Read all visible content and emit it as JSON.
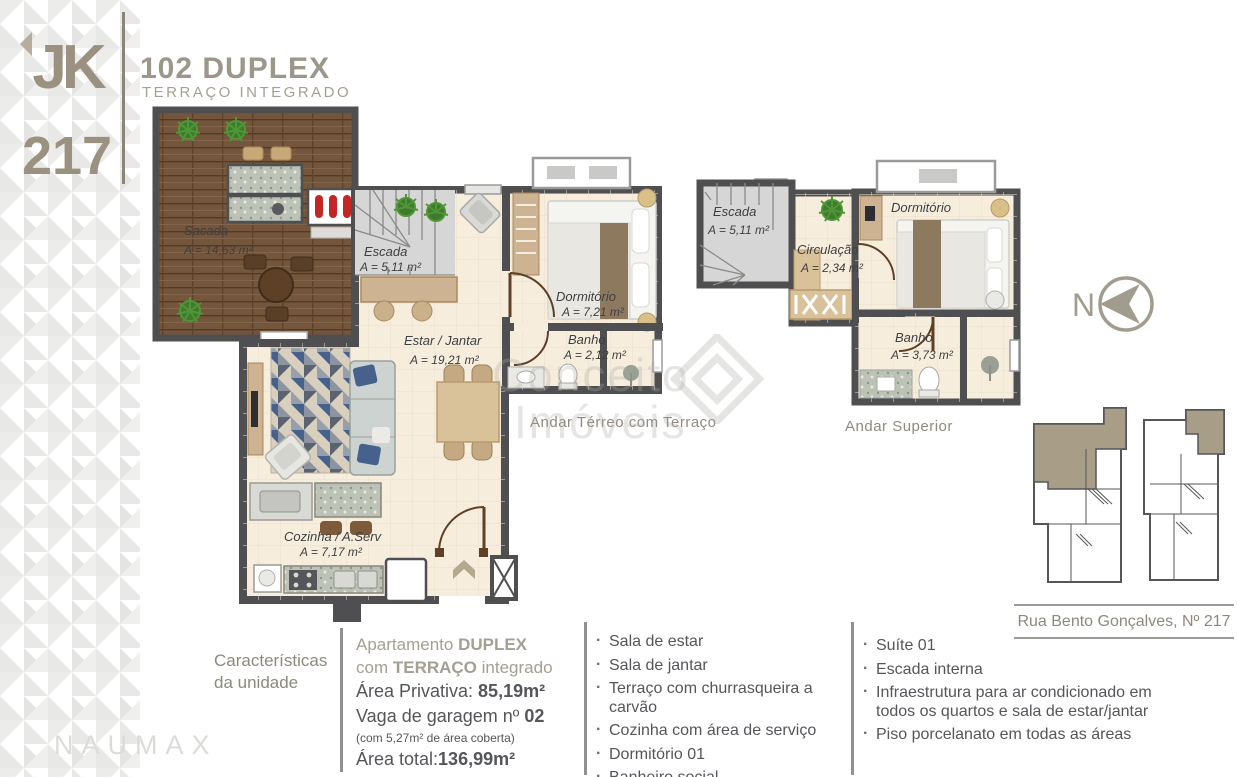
{
  "logo": {
    "letters": "JK",
    "number": "217"
  },
  "header": {
    "title": "102 DUPLEX",
    "subtitle": "TERRAÇO INTEGRADO"
  },
  "watermark": {
    "line1": "Conceito",
    "line2": "Imóveis"
  },
  "compass": {
    "label": "N"
  },
  "plans": {
    "ground": {
      "caption": "Andar Térreo com Terraço",
      "rooms": {
        "sacada": {
          "name": "Sacada",
          "area": "A = 14,63 m²"
        },
        "escada": {
          "name": "Escada",
          "area": "A = 5,11 m²"
        },
        "estar": {
          "name": "Estar / Jantar",
          "area": "A = 19,21 m²"
        },
        "dormitorio": {
          "name": "Dormitório",
          "area": "A = 7,21 m²"
        },
        "banho": {
          "name": "Banho",
          "area": "A = 2,12 m²"
        },
        "cozinha": {
          "name": "Cozinha / A.Serv",
          "area": "A = 7,17 m²"
        }
      }
    },
    "upper": {
      "caption": "Andar Superior",
      "rooms": {
        "escada": {
          "name": "Escada",
          "area": "A = 5,11 m²"
        },
        "circulacao": {
          "name": "Circulação",
          "area": "A = 2,34 m²"
        },
        "dormitorio": {
          "name": "Dormitório",
          "area": "A = 7,04 m²"
        },
        "banho": {
          "name": "Banho",
          "area": "A = 3,73 m²"
        }
      }
    }
  },
  "keyplan": {
    "address": "Rua Bento Gonçalves, Nº 217"
  },
  "unit": {
    "section_title_line1": "Características",
    "section_title_line2": "da unidade",
    "type_line1_pre": "Apartamento ",
    "type_line1_bold": "DUPLEX",
    "type_line2_pre": "com ",
    "type_line2_bold": "TERRAÇO",
    "type_line2_post": " integrado",
    "private_area_label": "Área Privativa: ",
    "private_area_value": "85,19m²",
    "garage_label": "Vaga de garagem nº ",
    "garage_value": "02",
    "garage_note": "(com 5,27m² de área coberta)",
    "total_area_label": "Área total:",
    "total_area_value": "136,99m²"
  },
  "features_left": [
    "Sala de estar",
    "Sala de jantar",
    "Terraço com churrasqueira a carvão",
    "Cozinha com área de serviço",
    "Dormitório 01",
    "Banheiro social"
  ],
  "features_right": [
    "Suíte 01",
    "Escada interna",
    "Infraestrutura para ar condicionado em todos os quartos e sala de estar/jantar",
    "Piso porcelanato em todas as áreas"
  ],
  "brand": {
    "name": "NAUMAX"
  },
  "colors": {
    "wall": "#4f4f52",
    "floor": "#f6eddd",
    "wood_deck": "#74563c",
    "accent_tan": "#a29c8e",
    "keyplan_highlight": "#a89d87",
    "text_dark": "#55565a",
    "text_tan": "#908a7e"
  }
}
